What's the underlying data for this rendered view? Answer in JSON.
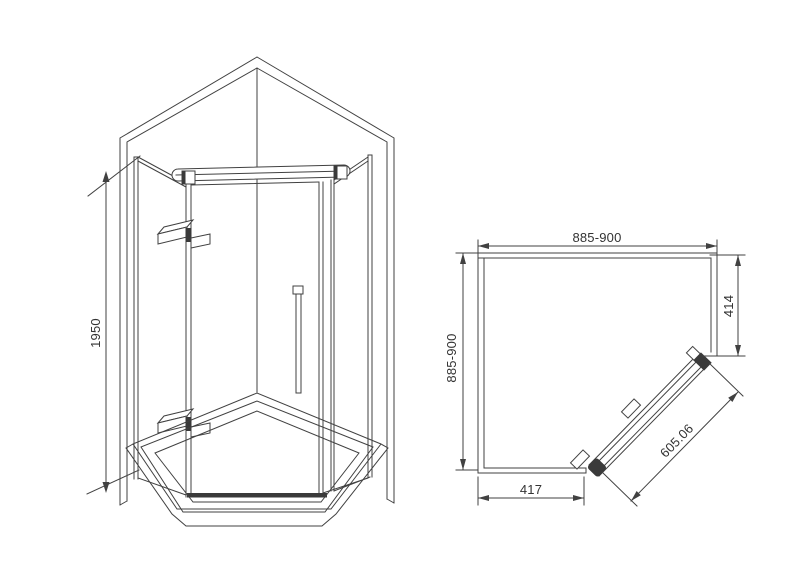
{
  "colors": {
    "background": "#ffffff",
    "line": "#414141",
    "text": "#333333",
    "dark_fill": "#3a3a3a"
  },
  "isometric_view": {
    "height_dim_label": "1950"
  },
  "plan_view": {
    "top_width_label": "885-900",
    "left_depth_label": "885-900",
    "right_panel_label": "414",
    "door_width_label": "605.06",
    "bottom_panel_label": "417"
  }
}
